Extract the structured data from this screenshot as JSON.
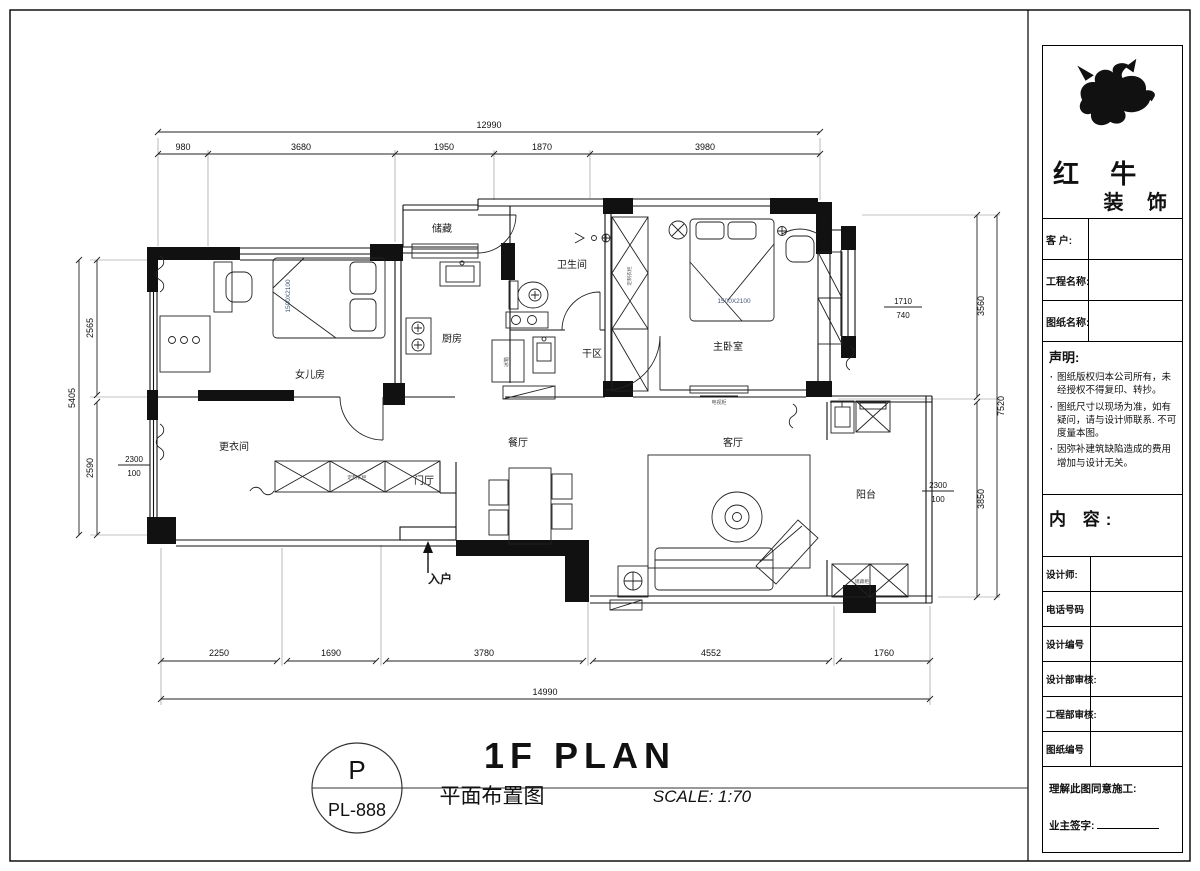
{
  "colors": {
    "line": "#111111",
    "bed_label": "#44557a"
  },
  "plan": {
    "rooms": {
      "daughter_room": "女儿房",
      "dressing_room": "更衣间",
      "foyer": "门厅",
      "dining_room": "餐厅",
      "kitchen": "厨房",
      "storage": "储藏",
      "bathroom": "卫生间",
      "dry_area": "干区",
      "master_bedroom": "主卧室",
      "living_room": "客厅",
      "balcony": "阳台",
      "entry": "入户"
    },
    "furniture_labels": {
      "bed_daughter": "1500X2100",
      "bed_master": "1500X2100",
      "tv_cabinet": "电视柜",
      "wardrobe": "定制衣柜",
      "wardrobe_row": "定制衣柜",
      "fridge": "冰箱",
      "balcony_cabinet": "储藏柜"
    },
    "dimensions": {
      "top_total": "12990",
      "top_segments": [
        "980",
        "3680",
        "1950",
        "1870",
        "3980"
      ],
      "bottom_segments": [
        "2250",
        "1690",
        "3780",
        "4552",
        "1760"
      ],
      "bottom_total": "14990",
      "left_total": "5405",
      "left_upper": "2565",
      "left_lower": "2590",
      "left_fraction_top": "2300",
      "left_fraction_bottom": "100",
      "right_total": "7520",
      "right_upper": "3560",
      "right_lower": "3850",
      "window_fraction_top": "1710",
      "window_fraction_bottom": "740",
      "right_fraction_top": "2300",
      "right_fraction_bottom": "100"
    }
  },
  "sheet_title": {
    "drawing_code_top": "P",
    "drawing_code_bottom": "PL-888",
    "title_en": "1F PLAN",
    "title_cn": "平面布置图",
    "scale": "SCALE: 1:70"
  },
  "title_block": {
    "logo": {
      "line1": "红 牛",
      "line2": "装 饰"
    },
    "fields": [
      {
        "label": "客 户:"
      },
      {
        "label": "工程名称:"
      },
      {
        "label": "图纸名称:"
      }
    ],
    "statement": {
      "heading": "声明:",
      "items": [
        "图纸版权归本公司所有，未经授权不得复印、转抄。",
        "图纸尺寸以现场为准，如有疑问，请与设计师联系. 不可度量本图。",
        "因弥补建筑缺陷造成的费用增加与设计无关。"
      ]
    },
    "content_heading": "内 容:",
    "rows": [
      {
        "label": "设计师:"
      },
      {
        "label": "电话号码"
      },
      {
        "label": "设计编号"
      },
      {
        "label": "设计部审核:"
      },
      {
        "label": "工程部审核:"
      },
      {
        "label": "图纸编号"
      }
    ],
    "footer": {
      "line1": "理解此图同意施工:",
      "line2": "业主签字:"
    }
  }
}
